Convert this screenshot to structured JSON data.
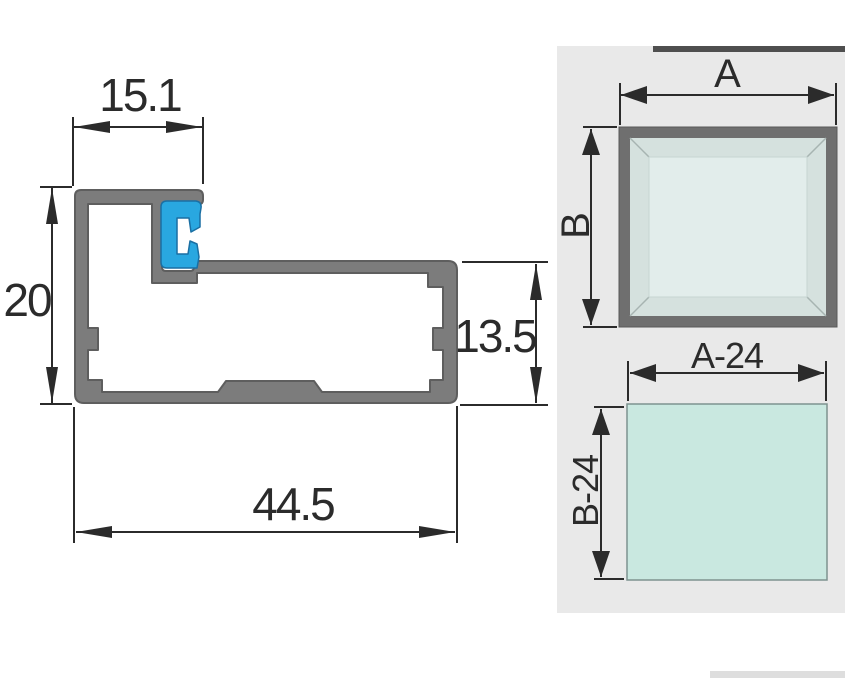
{
  "title": "Aluminum glazing profile cross-section technical drawing",
  "profile_view": {
    "dim_top_width": "15.1",
    "dim_left_height": "20",
    "dim_right_height": "13.5",
    "dim_bottom_width": "44.5"
  },
  "frame_view": {
    "dim_width": "A",
    "dim_height": "B"
  },
  "glass_view": {
    "dim_width": "A-24",
    "dim_height": "B-24"
  },
  "colors": {
    "line": "#2b2b2b",
    "profile_gray": "#7c7c7c",
    "profile_outline": "#5e5e5e",
    "clip_blue": "#29a7e0",
    "clip_outline": "#1a6fa3",
    "panel_bg": "#e9e9e9",
    "panel_top_strip": "#4f4f4f",
    "panel_bottom_strip": "#dedede",
    "frame_gray": "#6f6f6f",
    "frame_bevel": "#d5e1de",
    "frame_glass": "#e2edeb",
    "glass_mint": "#c9e8e0",
    "glass_border": "#7e928f"
  }
}
